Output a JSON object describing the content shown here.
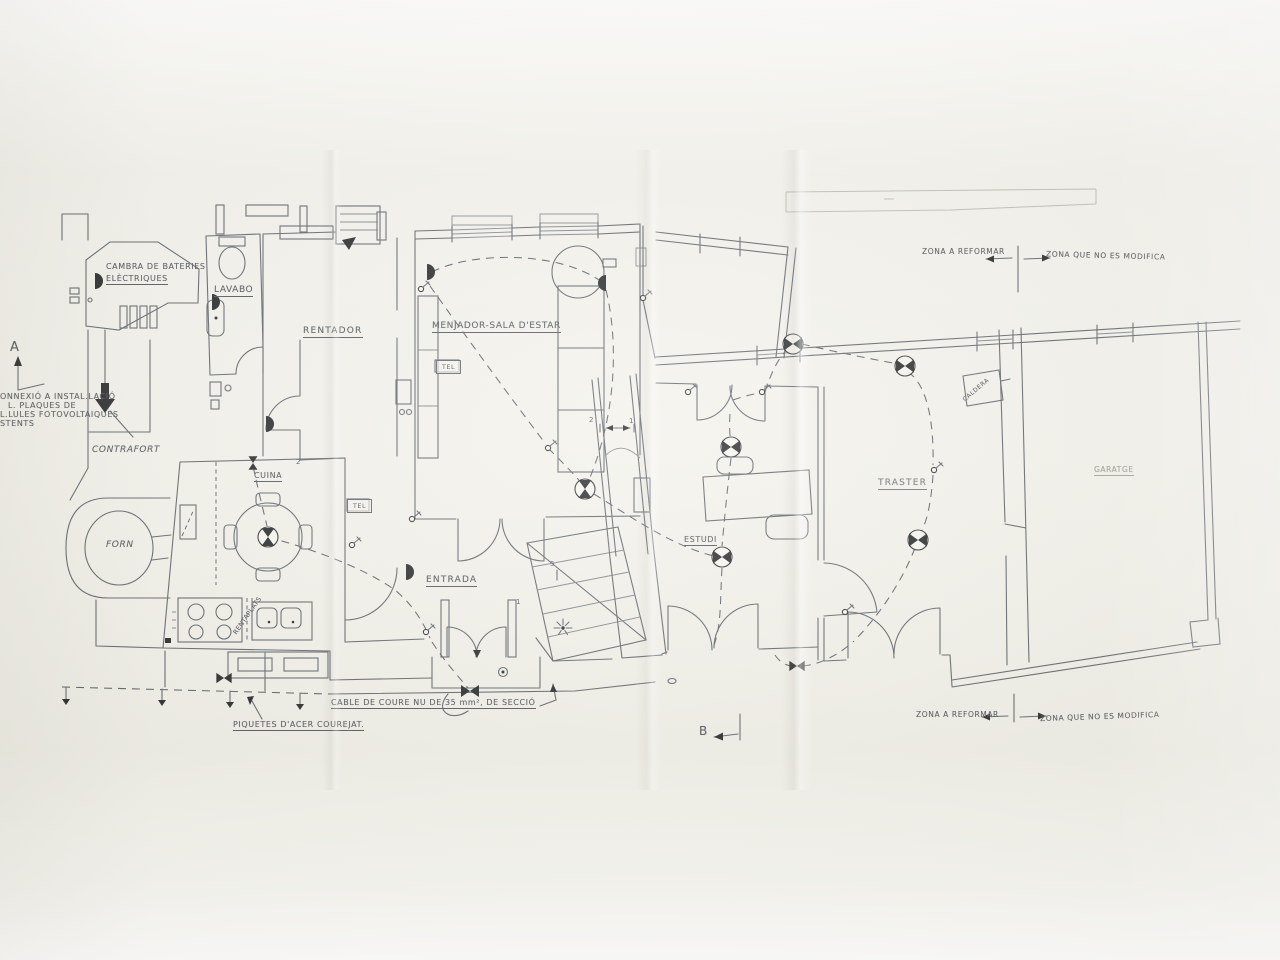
{
  "photo": {
    "paper_color": "#f2f1ea",
    "ink_color": "#5a6068",
    "symbol_color": "#1e2022",
    "text_color": "#4c5158"
  },
  "plan": {
    "rooms": {
      "cambra_line1": "CAMBRA DE BATERIES",
      "cambra_line2": "ELÈCTRIQUES",
      "lavabo": "LAVABO",
      "rentador": "RENTADOR",
      "menjador": "MENJADOR-SALA D'ESTAR",
      "cuina": "CUINA",
      "entrada": "ENTRADA",
      "estudi": "ESTUDI",
      "traster": "TRASTER",
      "garatge": "GARATGE",
      "forn": "FORN",
      "contrafort": "CONTRAFORT"
    },
    "fixtures": {
      "tel": "TEL",
      "rentaplats": "RENTAPLATS",
      "caldera": "CALDERA"
    },
    "section_markers": {
      "a": "A",
      "b": "B"
    },
    "zones": {
      "reformar": "ZONA A REFORMAR",
      "no_modifica": "ZONA QUE NO ES MODIFICA"
    },
    "notes": {
      "connexio_line1": "ONNEXIÓ A INSTAL.LACIÓ",
      "connexio_line2": "L. PLAQUES DE",
      "connexio_line3": "L.LULES FOTOVOLTAIQUES",
      "connexio_line4": "STENTS",
      "cable": "CABLE DE COURE NU DE 35 mm², DE SECCIÓ",
      "piquetes": "PIQUETES D'ACER COUREJAT."
    },
    "dimensions": {
      "d2a": "2",
      "d2b": "2",
      "d1a": "1",
      "d1b": "1",
      "d5": "5"
    }
  }
}
